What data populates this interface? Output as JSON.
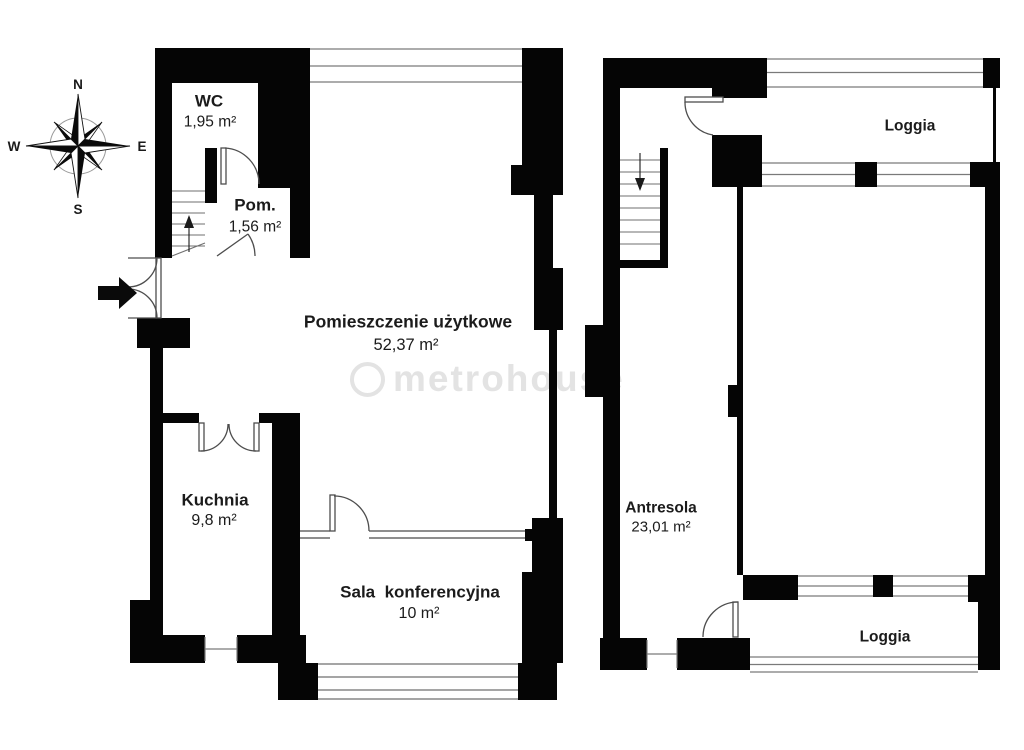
{
  "watermark": {
    "text": "metrohouse"
  },
  "compass": {
    "north": "N",
    "south": "S",
    "east": "E",
    "west": "W"
  },
  "floor1": {
    "wc": {
      "name": "WC",
      "area": "1,95 m²"
    },
    "pom": {
      "name": "Pom.",
      "area": "1,56 m²"
    },
    "main": {
      "name": "Pomieszczenie użytkowe",
      "area": "52,37 m²"
    },
    "kitchen": {
      "name": "Kuchnia",
      "area": "9,8 m²"
    },
    "conference": {
      "name": "Sala  konferencyjna",
      "area": "10 m²"
    }
  },
  "floor2": {
    "loggia_top": {
      "name": "Loggia"
    },
    "antresola": {
      "name": "Antresola",
      "area": "23,01 m²"
    },
    "loggia_bottom": {
      "name": "Loggia"
    }
  }
}
